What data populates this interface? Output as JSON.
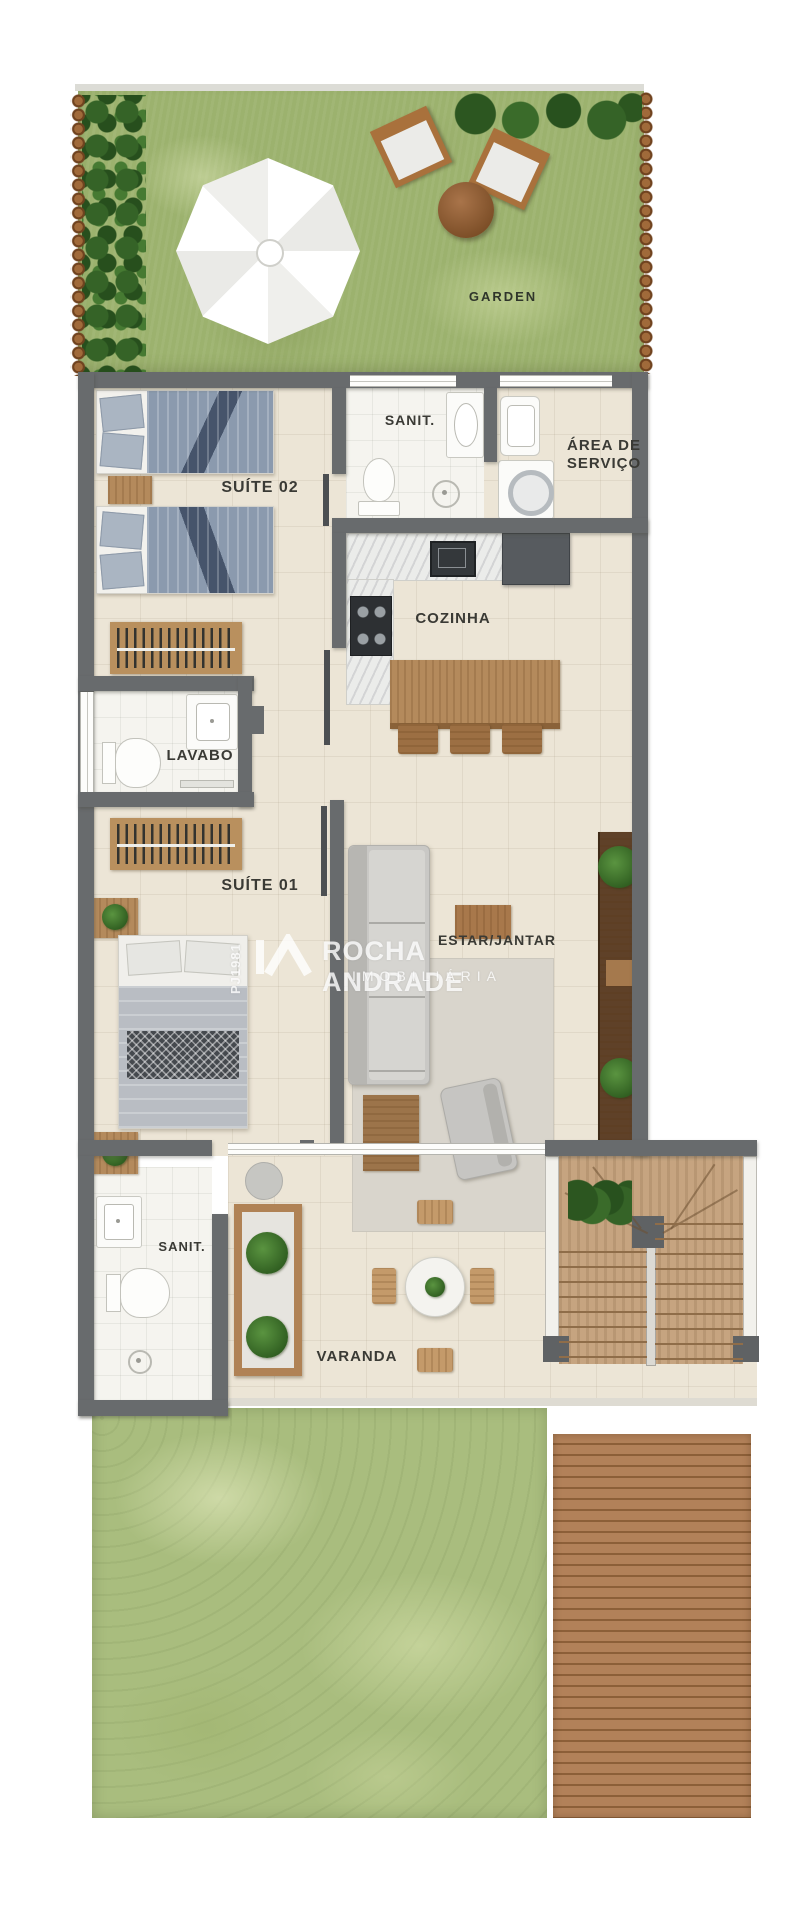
{
  "plan": {
    "rooms": {
      "garden": "GARDEN",
      "suite_02": "SUÍTE 02",
      "sanit_top": "SANIT.",
      "area_servico": [
        "ÁREA DE",
        "SERVIÇO"
      ],
      "cozinha": "COZINHA",
      "lavabo": "LAVABO",
      "suite_01": "SUÍTE 01",
      "estar_jantar": "ESTAR/JANTAR",
      "sanit_bottom": "SANIT.",
      "varanda": "VARANDA"
    },
    "watermark": {
      "code": "PJ1981",
      "name": "ROCHA ANDRADE",
      "subtitle": "IMOBILIÁRIA"
    },
    "colors": {
      "wall": "#686b6d",
      "floor_tile": "#ece5d6",
      "bathroom_tile": "#f5f4ef",
      "garden_grass": "#9cb26e",
      "yard_grass": "#a9bd7e",
      "deck_wood": "#ab7c55",
      "furniture_wood": "#b48a5c",
      "hedge_green": "#335c26",
      "bed_blue": "#8b9aae",
      "stair_wood": "#c2a07c",
      "watermark_white": "rgba(255,255,255,0.8)"
    }
  }
}
